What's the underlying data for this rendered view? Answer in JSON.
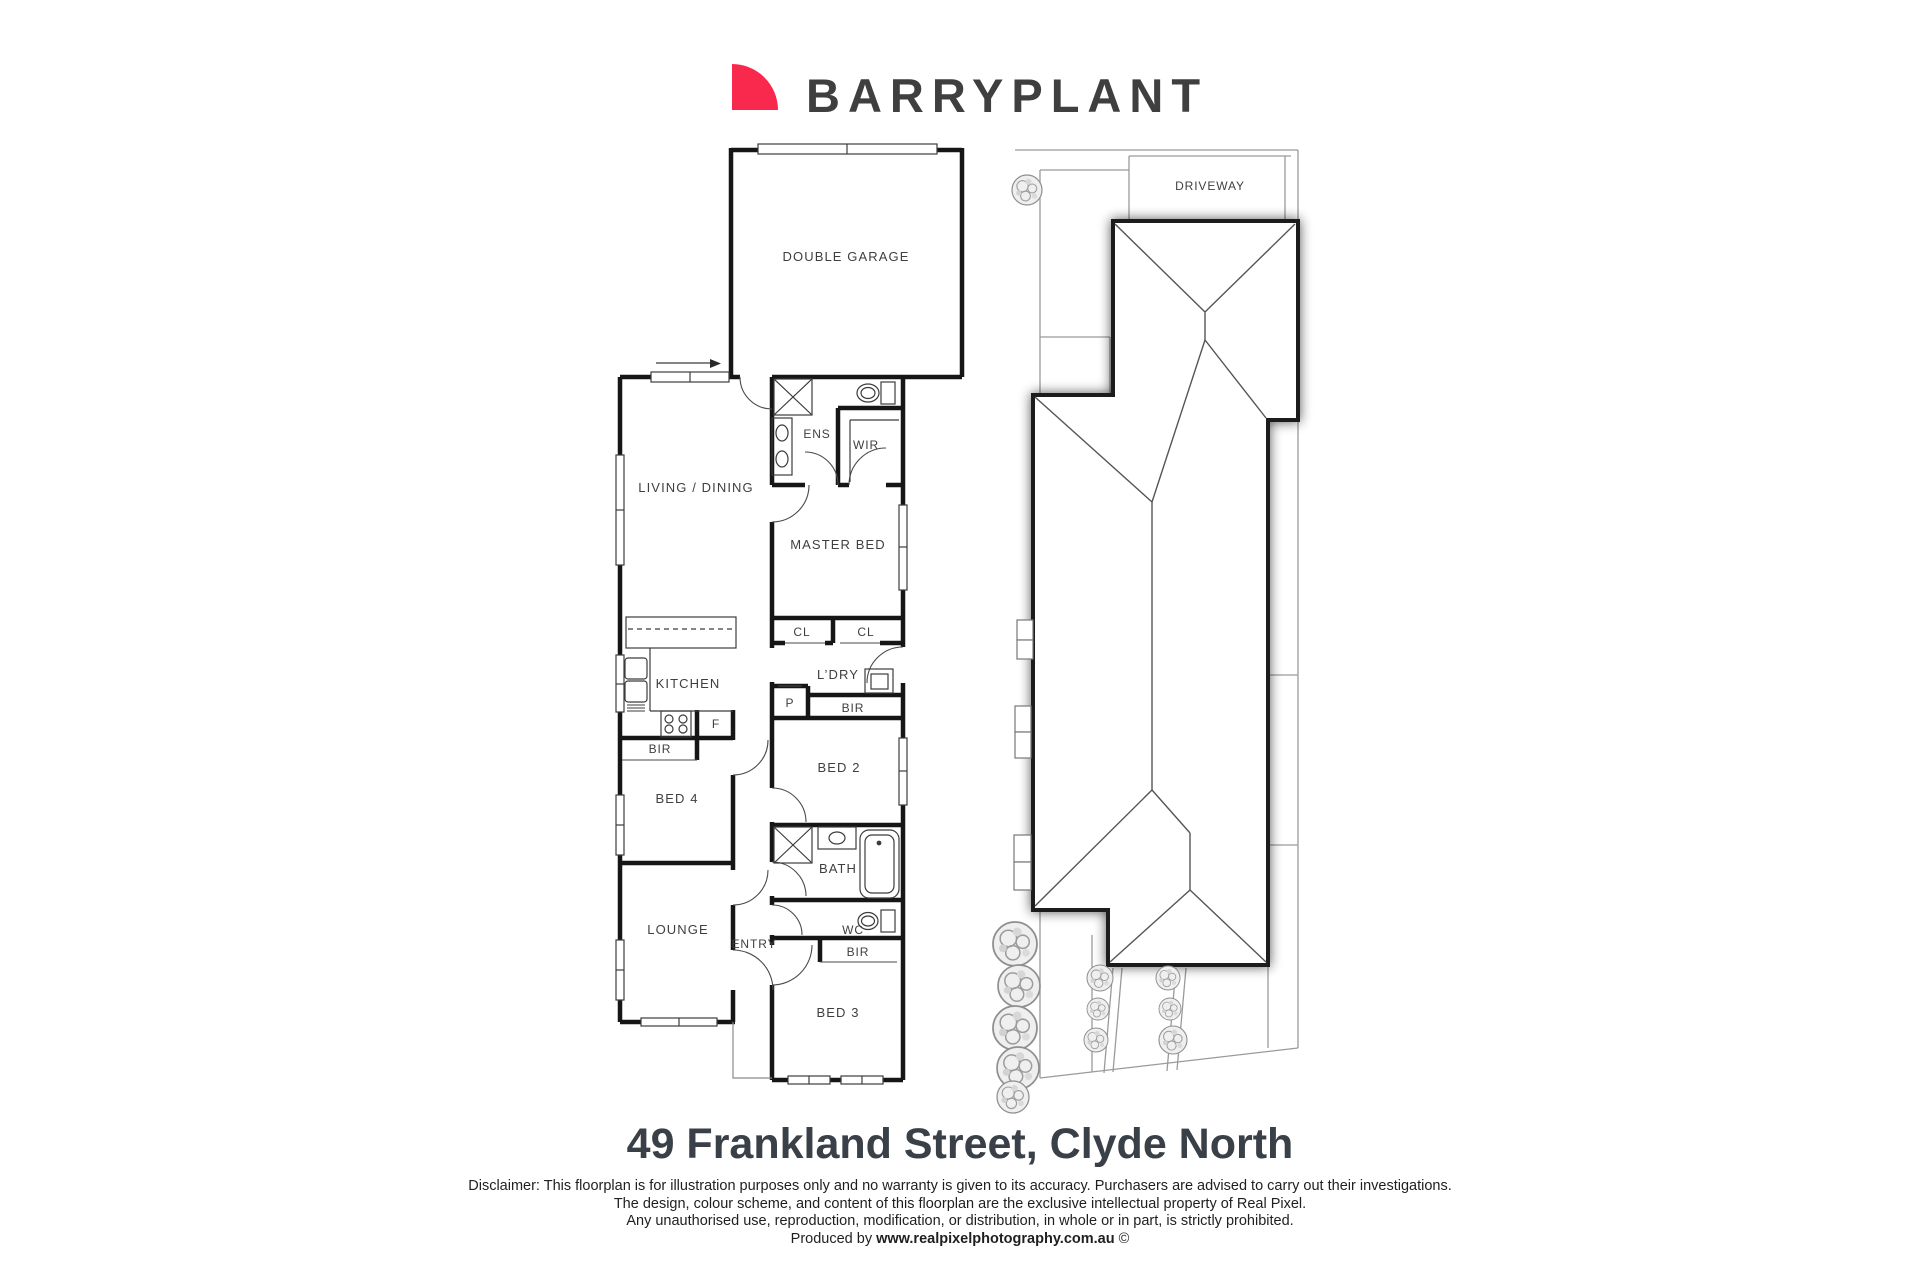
{
  "logo": {
    "brand": "BARRYPLANT"
  },
  "colors": {
    "logo_red": "#F8294D",
    "logo_blue": "#1D3EB5",
    "wall": "#161616",
    "thin_line": "#3c3c3c",
    "site_line": "#9a9a9a",
    "title_text": "#3a4048"
  },
  "floorplan": {
    "labels": {
      "garage": "DOUBLE GARAGE",
      "living": "LIVING / DINING",
      "ens": "ENS",
      "wir": "WIR",
      "master": "MASTER BED",
      "cl1": "CL",
      "cl2": "CL",
      "ldry": "L’DRY",
      "p": "P",
      "bir_bed2": "BIR",
      "bed2": "BED 2",
      "kitchen": "KITCHEN",
      "fridge": "F",
      "bir_bed4": "BIR",
      "bed4": "BED 4",
      "bath": "BATH",
      "lounge": "LOUNGE",
      "entry": "ENTRY",
      "wc": "WC",
      "bir_bed3": "BIR",
      "bed3": "BED 3"
    }
  },
  "siteplan": {
    "labels": {
      "driveway": "DRIVEWAY"
    }
  },
  "footer": {
    "address": "49 Frankland Street, Clyde North",
    "disclaimer1": "Disclaimer: This floorplan is for illustration purposes only and no warranty is given to its accuracy. Purchasers are advised to carry out their investigations.",
    "disclaimer2": "The design, colour scheme, and content of this floorplan are the exclusive intellectual property of Real Pixel.",
    "disclaimer3": "Any unauthorised use, reproduction, modification, or distribution, in whole or in part, is strictly prohibited.",
    "produced_prefix": "Produced by ",
    "produced_site": "www.realpixelphotography.com.au",
    "produced_suffix": " ©"
  }
}
